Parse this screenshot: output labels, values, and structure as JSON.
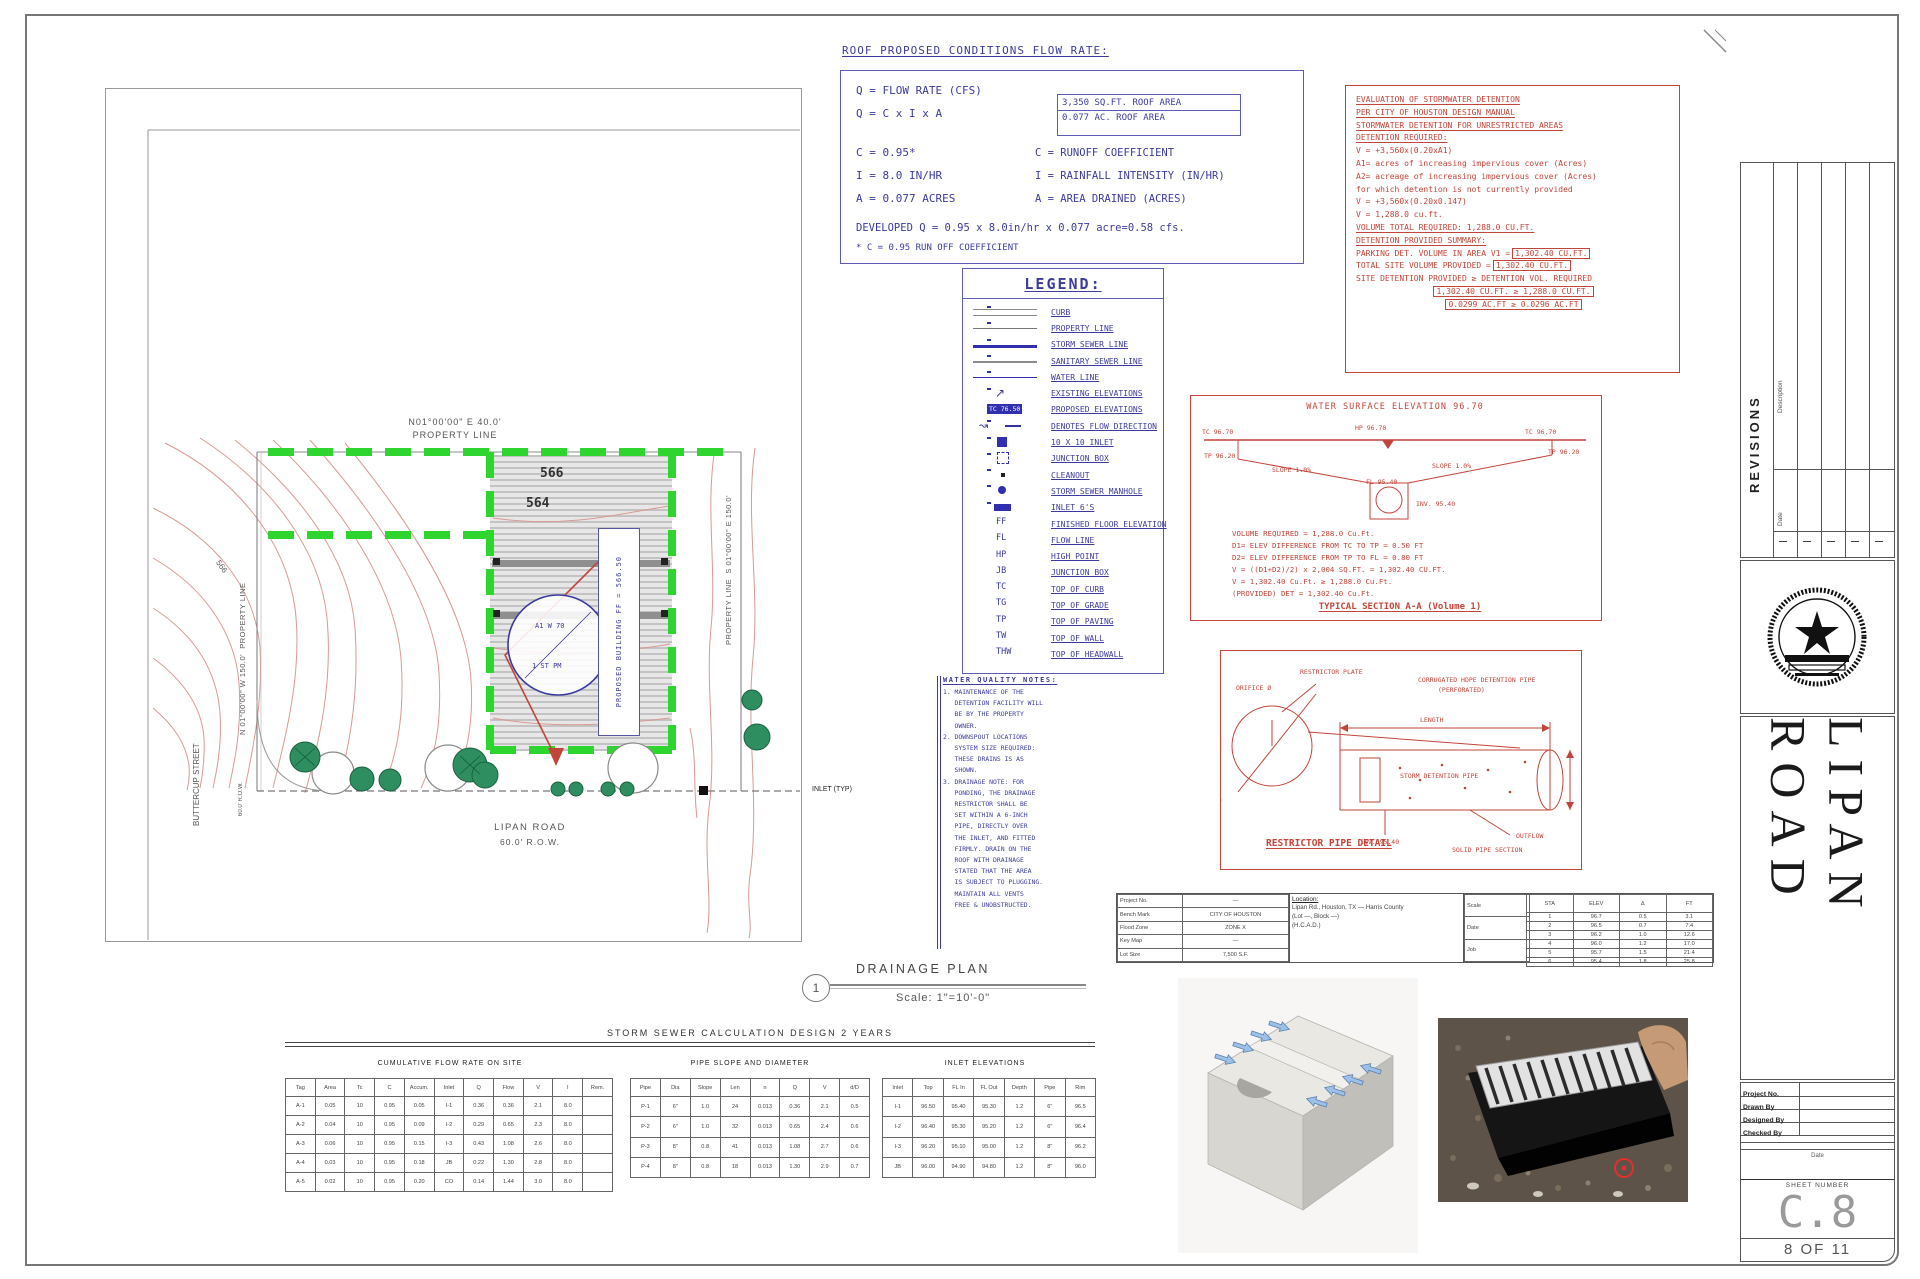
{
  "flow_block": {
    "title": "ROOF PROPOSED CONDITIONS FLOW RATE:",
    "lines_left": [
      "Q  =  FLOW RATE (CFS)",
      "Q  =  C x I x A",
      "C  =  0.95*",
      "I  =  8.0 IN/HR",
      "A  =  0.077 ACRES"
    ],
    "roof_box": [
      "3,350 SQ.FT. ROOF AREA",
      "0.077 AC. ROOF AREA"
    ],
    "defs": [
      "C   =  RUNOFF COEFFICIENT",
      "I   =  RAINFALL INTENSITY (IN/HR)",
      "A   =  AREA DRAINED (ACRES)"
    ],
    "developed": "DEVELOPED Q = 0.95 x 8.0in/hr x 0.077 acre=0.58 cfs.",
    "footnote": "* C = 0.95 RUN OFF COEFFICIENT"
  },
  "legend": {
    "title": "LEGEND:",
    "items": [
      {
        "sym": "curb",
        "symtext": "",
        "label": "CURB"
      },
      {
        "sym": "prop",
        "symtext": "",
        "label": "PROPERTY LINE"
      },
      {
        "sym": "storm",
        "symtext": "",
        "label": "STORM SEWER LINE"
      },
      {
        "sym": "san",
        "symtext": "",
        "label": "SANITARY SEWER LINE"
      },
      {
        "sym": "water",
        "symtext": "",
        "label": "WATER LINE"
      },
      {
        "sym": "exelev",
        "symtext": "",
        "label": "EXISTING ELEVATIONS"
      },
      {
        "sym": "prelev",
        "symtext": "TC 76.50",
        "label": "PROPOSED ELEVATIONS"
      },
      {
        "sym": "flow",
        "symtext": "",
        "label": "DENOTES FLOW DIRECTION"
      },
      {
        "sym": "inlet10",
        "symtext": "",
        "label": "10 X 10 INLET"
      },
      {
        "sym": "jbox",
        "symtext": "",
        "label": "JUNCTION BOX"
      },
      {
        "sym": "cleanout",
        "symtext": "",
        "label": "CLEANOUT"
      },
      {
        "sym": "manhole",
        "symtext": "",
        "label": "STORM SEWER MANHOLE"
      },
      {
        "sym": "inlet6",
        "symtext": "",
        "label": "INLET 6'S"
      },
      {
        "sym": "abbr",
        "symtext": "FF",
        "label": "FINISHED FLOOR ELEVATION"
      },
      {
        "sym": "abbr",
        "symtext": "FL",
        "label": "FLOW LINE"
      },
      {
        "sym": "abbr",
        "symtext": "HP",
        "label": "HIGH POINT"
      },
      {
        "sym": "abbr",
        "symtext": "JB",
        "label": "JUNCTION BOX"
      },
      {
        "sym": "abbr",
        "symtext": "TC",
        "label": "TOP OF CURB"
      },
      {
        "sym": "abbr",
        "symtext": "TG",
        "label": "TOP OF GRADE"
      },
      {
        "sym": "abbr",
        "symtext": "TP",
        "label": "TOP OF PAVING"
      },
      {
        "sym": "abbr",
        "symtext": "TW",
        "label": "TOP OF WALL"
      },
      {
        "sym": "abbr",
        "symtext": "THW",
        "label": "TOP OF HEADWALL"
      }
    ]
  },
  "detention": {
    "lines": [
      {
        "t": "EVALUATION OF STORMWATER DETENTION",
        "box": "",
        "cls": "u"
      },
      {
        "t": "PER CITY OF HOUSTON DESIGN MANUAL",
        "box": "",
        "cls": "u"
      },
      {
        "t": "STORMWATER DETENTION FOR UNRESTRICTED AREAS",
        "box": "",
        "cls": "u"
      },
      {
        "t": "DETENTION REQUIRED:",
        "box": "",
        "cls": "u"
      },
      {
        "t": "V  =  +3,560x(0.20xA1)",
        "box": "",
        "cls": ""
      },
      {
        "t": "A1= acres of increasing impervious cover (Acres)",
        "box": "",
        "cls": ""
      },
      {
        "t": "A2= acreage of increasing impervious cover (Acres)",
        "box": "",
        "cls": ""
      },
      {
        "t": "     for which detention is not currently provided",
        "box": "",
        "cls": ""
      },
      {
        "t": "V  =  +3,560x(0.20x0.147)",
        "box": "",
        "cls": ""
      },
      {
        "t": "V  =  1,288.0  cu.ft.",
        "box": "",
        "cls": ""
      },
      {
        "t": " ",
        "box": "",
        "cls": ""
      },
      {
        "t": "VOLUME TOTAL REQUIRED: 1,288.0 CU.FT.",
        "box": "",
        "cls": "u"
      },
      {
        "t": " ",
        "box": "",
        "cls": ""
      },
      {
        "t": "DETENTION PROVIDED SUMMARY:",
        "box": "",
        "cls": "u"
      },
      {
        "t": "PARKING DET. VOLUME IN AREA V1 =",
        "box": "1,302.40 CU.FT.",
        "cls": ""
      },
      {
        "t": " ",
        "box": "",
        "cls": ""
      },
      {
        "t": "TOTAL SITE VOLUME PROVIDED =",
        "box": "1,302.40 CU.FT.",
        "cls": ""
      },
      {
        "t": "SITE DETENTION PROVIDED ≥ DETENTION VOL. REQUIRED",
        "box": "",
        "cls": ""
      },
      {
        "t": "",
        "box": "1,302.40 CU.FT.  ≥  1,288.0 CU.FT.",
        "cls": "c"
      },
      {
        "t": "",
        "box": "0.0299 AC.FT  ≥  0.0296 AC.FT",
        "cls": "c"
      }
    ]
  },
  "section": {
    "title": "WATER SURFACE ELEVATION  96.70",
    "labels": {
      "tc_l": "TC 96.70",
      "hp": "HP 96.70",
      "tc_r": "TC 96.70",
      "tp_l": "TP 96.20",
      "tp_r": "TP 96.20",
      "slope_l": "SLOPE 1.0%",
      "slope_r": "SLOPE 1.0%",
      "fl": "FL 95.40",
      "inv": "INV. 95.40"
    },
    "lines": [
      "VOLUME REQUIRED = 1,288.0 Cu.Ft.",
      "D1= ELEV DIFFERENCE FROM TC TO TP = 0.50 FT",
      "D2= ELEV DIFFERENCE FROM TP TO FL = 0.80 FT",
      "V = ((D1+D2)/2) x 2,004 SQ.FT. = 1,302.40 CU.FT.",
      "V = 1,302.40 Cu.Ft. ≥ 1,288.0 Cu.Ft.",
      "(PROVIDED) DET = 1,302.40 Cu.Ft."
    ],
    "caption": "TYPICAL SECTION A-A (Volume 1)"
  },
  "restrictor": {
    "caption": "RESTRICTOR PIPE DETAIL",
    "labels": {
      "plate": "RESTRICTOR PLATE",
      "orifice": "ORIFICE Ø",
      "pipe1": "CORRUGATED HDPE DETENTION PIPE",
      "pipe2": "(PERFORATED)",
      "inside": "STORM DETENTION PIPE",
      "length": "LENGTH",
      "inv": "INV. 95.40",
      "outflow": "OUTFLOW",
      "solid": "SOLID PIPE SECTION"
    }
  },
  "notes": {
    "title": "WATER QUALITY NOTES:",
    "lines": [
      "1. MAINTENANCE OF THE",
      "   DETENTION FACILITY WILL",
      "   BE BY THE PROPERTY",
      "   OWNER.",
      "2. DOWNSPOUT LOCATIONS",
      "   SYSTEM SIZE REQUIRED:",
      "   THESE DRAINS IS AS",
      "   SHOWN.",
      "3. DRAINAGE NOTE: FOR",
      "   PONDING, THE DRAINAGE",
      "   RESTRICTOR SHALL BE",
      "   SET WITHIN A 6-INCH",
      "   PIPE, DIRECTLY OVER",
      "   THE INLET, AND FITTED",
      "   FIRMLY. DRAIN ON THE",
      "   ROOF WITH DRAINAGE",
      "   STATED THAT THE AREA",
      "   IS SUBJECT TO PLUGGING.",
      "   MAINTAIN ALL VENTS",
      "   FREE & UNOBSTRUCTED."
    ]
  },
  "project_table": {
    "left": {
      "rows": [
        [
          "Project No.",
          "—"
        ],
        [
          "Bench Mark",
          "CITY OF HOUSTON"
        ],
        [
          "Flood Zone",
          "ZONE X"
        ],
        [
          "Key Map",
          "—"
        ],
        [
          "Lot Size",
          "7,500 S.F."
        ]
      ]
    },
    "location_title": "Location:",
    "location_lines": [
      "Lipan Rd., Houston, TX — Harris County",
      "(Lot —, Block —)",
      "(H.C.A.D.)"
    ],
    "small": {
      "rows": [
        [
          "Scale",
          "1\"=10'"
        ],
        [
          "Date",
          "—"
        ],
        [
          "Job",
          "—"
        ]
      ]
    },
    "grid": {
      "headers": [
        "STA",
        "ELEV",
        "Δ",
        "FT"
      ],
      "rows": [
        [
          "1",
          "96.7",
          "0.5",
          "3.1"
        ],
        [
          "2",
          "96.5",
          "0.7",
          "7.4"
        ],
        [
          "3",
          "96.2",
          "1.0",
          "12.6"
        ],
        [
          "4",
          "96.0",
          "1.2",
          "17.0"
        ],
        [
          "5",
          "95.7",
          "1.5",
          "21.4"
        ],
        [
          "6",
          "95.4",
          "1.8",
          "25.8"
        ]
      ]
    }
  },
  "drainage_callout": {
    "number": "1",
    "title": "DRAINAGE PLAN",
    "scale": "Scale:    1\"=10'-0\""
  },
  "site_plan": {
    "top_bearing": "N01°00'00\" E 40.0'",
    "top_label": "PROPERTY LINE",
    "left_bearing": "N 01°00'00\" W 150.0'",
    "left_label": "PROPERTY LINE",
    "right_label": "PROPERTY LINE",
    "right_bearing": "S 01°00'00\" E 150.0'",
    "contour_a": "566",
    "contour_b": "564",
    "swale_label": "566",
    "street_v1": "BUTTERCUP",
    "street_v2": "STREET",
    "street_row": "60.0' R.O.W.",
    "road_name": "LIPAN ROAD",
    "road_row": "60.0' R.O.W.",
    "inlet_label": "INLET (TYP)",
    "circle_text1": "A1 W 70",
    "circle_text2": "1 ST PM",
    "building_label": "PROPOSED BUILDING  FF = 566.50"
  },
  "calc": {
    "header": "STORM SEWER CALCULATION DESIGN 2 YEARS",
    "t1_title": "CUMULATIVE FLOW RATE ON SITE",
    "t2_title": "PIPE SLOPE AND DIAMETER",
    "t3_title": "INLET ELEVATIONS",
    "t1": {
      "headers": [
        "Tag",
        "Area",
        "Tc",
        "C",
        "Accum.",
        "Inlet",
        "Q",
        "Flow",
        "V",
        "I",
        "Rem."
      ],
      "rows": [
        [
          "A-1",
          "0.05",
          "10",
          "0.95",
          "0.05",
          "I-1",
          "0.36",
          "0.36",
          "2.1",
          "8.0",
          ""
        ],
        [
          "A-2",
          "0.04",
          "10",
          "0.95",
          "0.09",
          "I-2",
          "0.29",
          "0.65",
          "2.3",
          "8.0",
          ""
        ],
        [
          "A-3",
          "0.06",
          "10",
          "0.95",
          "0.15",
          "I-3",
          "0.43",
          "1.08",
          "2.6",
          "8.0",
          ""
        ],
        [
          "A-4",
          "0.03",
          "10",
          "0.95",
          "0.18",
          "JB",
          "0.22",
          "1.30",
          "2.8",
          "8.0",
          ""
        ],
        [
          "A-5",
          "0.02",
          "10",
          "0.95",
          "0.20",
          "CO",
          "0.14",
          "1.44",
          "3.0",
          "8.0",
          ""
        ]
      ]
    },
    "t2": {
      "headers": [
        "Pipe",
        "Dia",
        "Slope",
        "Len",
        "n",
        "Q",
        "V",
        "d/D"
      ],
      "rows": [
        [
          "P-1",
          "6\"",
          "1.0",
          "24",
          "0.013",
          "0.36",
          "2.1",
          "0.5"
        ],
        [
          "P-2",
          "6\"",
          "1.0",
          "32",
          "0.013",
          "0.65",
          "2.4",
          "0.6"
        ],
        [
          "P-3",
          "8\"",
          "0.8",
          "41",
          "0.013",
          "1.08",
          "2.7",
          "0.6"
        ],
        [
          "P-4",
          "8\"",
          "0.8",
          "18",
          "0.013",
          "1.30",
          "2.9",
          "0.7"
        ]
      ]
    },
    "t3": {
      "headers": [
        "Inlet",
        "Top",
        "FL In",
        "FL Out",
        "Depth",
        "Pipe",
        "Rim"
      ],
      "rows": [
        [
          "I-1",
          "96.50",
          "95.40",
          "95.30",
          "1.2",
          "6\"",
          "96.5"
        ],
        [
          "I-2",
          "96.40",
          "95.30",
          "95.20",
          "1.2",
          "6\"",
          "96.4"
        ],
        [
          "I-3",
          "96.20",
          "95.10",
          "95.00",
          "1.2",
          "8\"",
          "96.2"
        ],
        [
          "JB",
          "96.00",
          "94.90",
          "94.80",
          "1.2",
          "8\"",
          "96.0"
        ]
      ]
    }
  },
  "titleblock": {
    "revisions_label": "REVISIONS",
    "rev_col1": "Description",
    "rev_col2": "Date",
    "road_title": "LIPAN ROAD",
    "rows": [
      "Project No.",
      "Drawn By",
      "Designed By",
      "Checked By"
    ],
    "date_label": "Date",
    "sheet_number_label": "SHEET NUMBER",
    "sheet_no": "C.8",
    "page": "8 OF 11"
  }
}
